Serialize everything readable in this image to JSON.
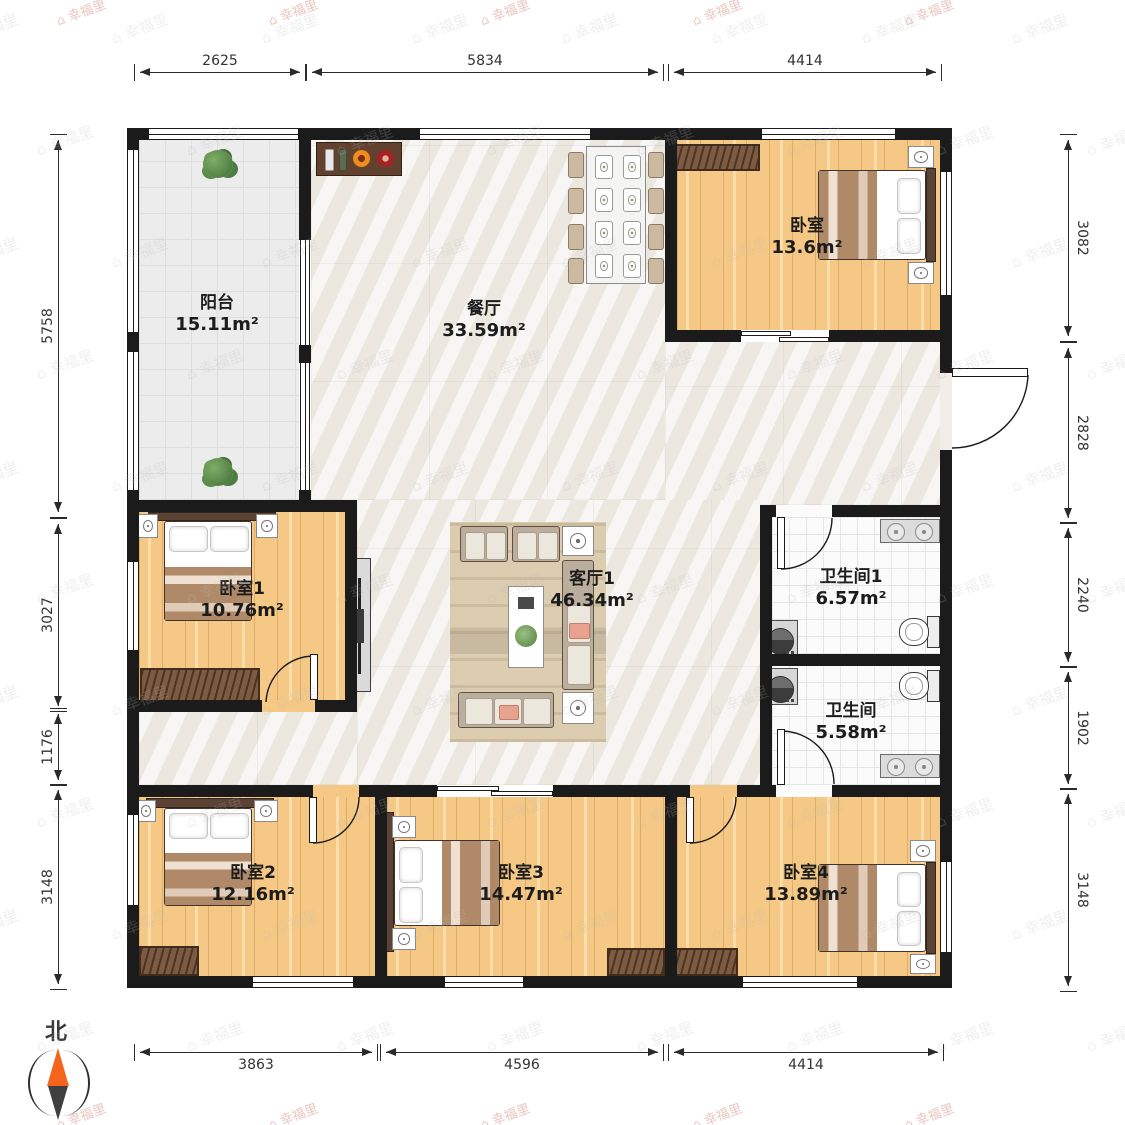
{
  "watermark": {
    "icon": "⌂",
    "text": "幸福里"
  },
  "compass": {
    "north_label": "北"
  },
  "rooms": {
    "balcony": {
      "name": "阳台",
      "area": "15.11m²"
    },
    "dining": {
      "name": "餐厅",
      "area": "33.59m²"
    },
    "bedroom_top": {
      "name": "卧室",
      "area": "13.6m²"
    },
    "bedroom1": {
      "name": "卧室1",
      "area": "10.76m²"
    },
    "living": {
      "name": "客厅1",
      "area": "46.34m²"
    },
    "bathroom1": {
      "name": "卫生间1",
      "area": "6.57m²"
    },
    "bathroom2": {
      "name": "卫生间",
      "area": "5.58m²"
    },
    "bedroom2": {
      "name": "卧室2",
      "area": "12.16m²"
    },
    "bedroom3": {
      "name": "卧室3",
      "area": "14.47m²"
    },
    "bedroom4": {
      "name": "卧室4",
      "area": "13.89m²"
    }
  },
  "dimensions": {
    "top": [
      "2625",
      "5834",
      "4414"
    ],
    "bottom": [
      "3863",
      "4596",
      "4414"
    ],
    "left": [
      "5758",
      "3027",
      "1176",
      "3148"
    ],
    "right": [
      "3082",
      "2828",
      "2240",
      "1902",
      "3148"
    ]
  },
  "colors": {
    "wall": "#1b1b1b",
    "wood_floor": "#f5c985",
    "marble_floor": "#f1eee8",
    "compass_north": "#f4641d",
    "furniture_brown": "#7d5b43"
  }
}
